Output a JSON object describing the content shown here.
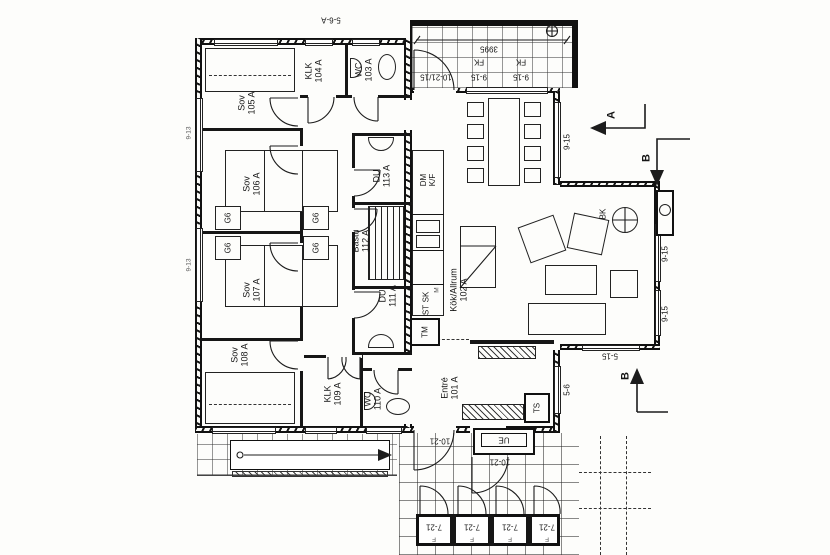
{
  "plan": {
    "title_hint": "Swedish cottage floor plan",
    "colors": {
      "ink": "#161616",
      "paper": "#fdfdfb"
    },
    "rooms": {
      "entre": {
        "name": "Entré",
        "number": "101 A"
      },
      "kok": {
        "name": "Kök/Allrum",
        "number": "102 A"
      },
      "wc103": {
        "name": "WC",
        "number": "103 A"
      },
      "klk104": {
        "name": "KLK",
        "number": "104 A"
      },
      "sov105": {
        "name": "Sov",
        "number": "105 A"
      },
      "sov106": {
        "name": "Sov",
        "number": "106 A"
      },
      "sov107": {
        "name": "Sov",
        "number": "107 A"
      },
      "sov108": {
        "name": "Sov",
        "number": "108 A"
      },
      "klk109": {
        "name": "KLK",
        "number": "109 A"
      },
      "wc110": {
        "name": "WC",
        "number": "110 A"
      },
      "du111": {
        "name": "DU",
        "number": "111 A"
      },
      "bastu112": {
        "name": "Bastu",
        "number": "112 A"
      },
      "du113": {
        "name": "DU",
        "number": "113 A"
      }
    },
    "fixtures": {
      "wardrobe": "G6",
      "dishwasher": "DM",
      "fridge_freezer": "K/F",
      "micro": "M",
      "cabinet": "SK",
      "tall_cabinet": "ST",
      "washer": "TM",
      "drying_cabinet": "TS",
      "stove": "BK",
      "outdoor_unit": "UE"
    },
    "dimensions": {
      "deck_length": "3995",
      "fixed_window": "FK",
      "win_915": "9-15",
      "door_102115": "10-21/15",
      "door_1021": "10-21",
      "door_721": "7-21",
      "win_515": "5-15",
      "win_56": "5-6",
      "win_56a": "5-6-A",
      "win_913": "9-13",
      "leaf": "F"
    },
    "sections": {
      "a": "A",
      "b": "B"
    }
  }
}
